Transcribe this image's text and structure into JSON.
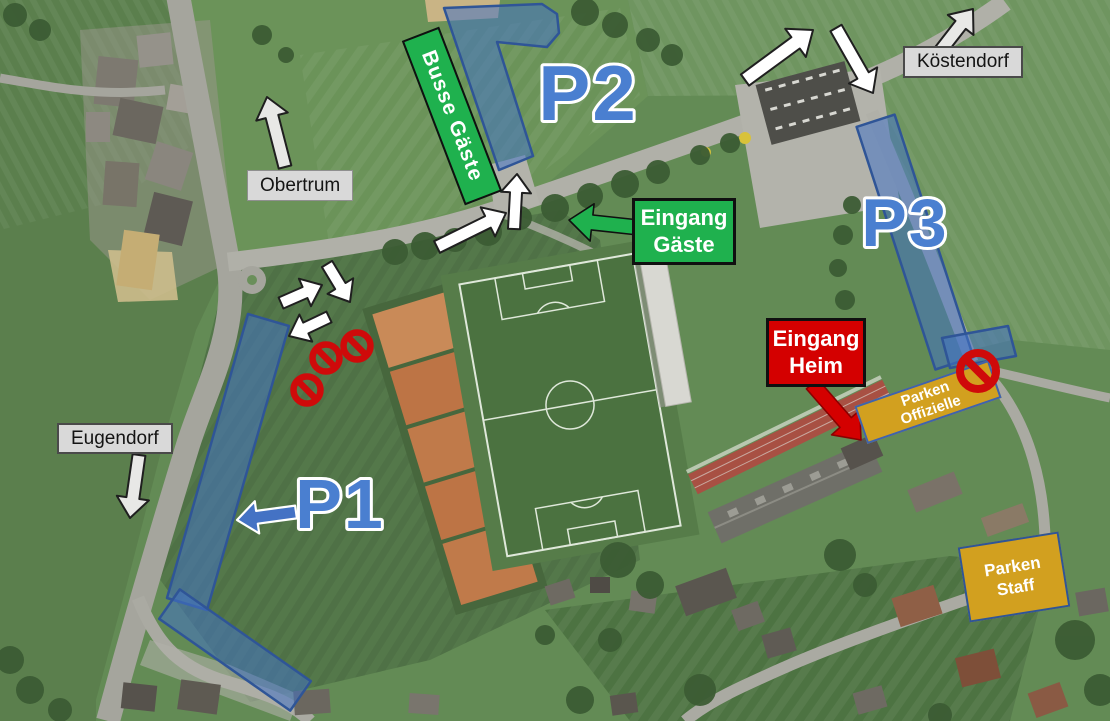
{
  "map": {
    "kind": "satellite-annotated",
    "parking_zones": [
      {
        "id": "p1",
        "label": "P1"
      },
      {
        "id": "p2",
        "label": "P2"
      },
      {
        "id": "p3",
        "label": "P3"
      }
    ],
    "bus_area": {
      "label": "Busse Gäste"
    },
    "entrances": {
      "guests": {
        "line1": "Eingang",
        "line2": "Gäste"
      },
      "home": {
        "line1": "Eingang",
        "line2": "Heim"
      }
    },
    "reserved_parking": {
      "officials": {
        "line1": "Parken",
        "line2": "Offizielle"
      },
      "staff": {
        "line1": "Parken",
        "line2": "Staff"
      }
    },
    "directions": {
      "obertrum": {
        "label": "Obertrum"
      },
      "eugendorf": {
        "label": "Eugendorf"
      },
      "koestendorf": {
        "label": "Köstendorf"
      }
    },
    "no_entry_sign_count": 4
  },
  "colors": {
    "overlay_blue": "#4472c4",
    "overlay_border_blue": "#2f5597",
    "zone_text_blue": "#4a7fd0",
    "entrance_green": "#1fb14e",
    "entrance_red": "#d40000",
    "red_arrow_dark": "#8a0000",
    "box_border_black": "#101010",
    "gold": "#d2a01f",
    "gold_border": "#3f63ad",
    "direction_label_bg": "#d9d9d9",
    "direction_label_border": "#4a4a4a",
    "no_entry_red": "#cf0a0a",
    "flow_arrow_fill": "#ffffff",
    "flow_arrow_outline": "#1f1f1f",
    "direction_arrow_fill": "#e8e8e6"
  }
}
